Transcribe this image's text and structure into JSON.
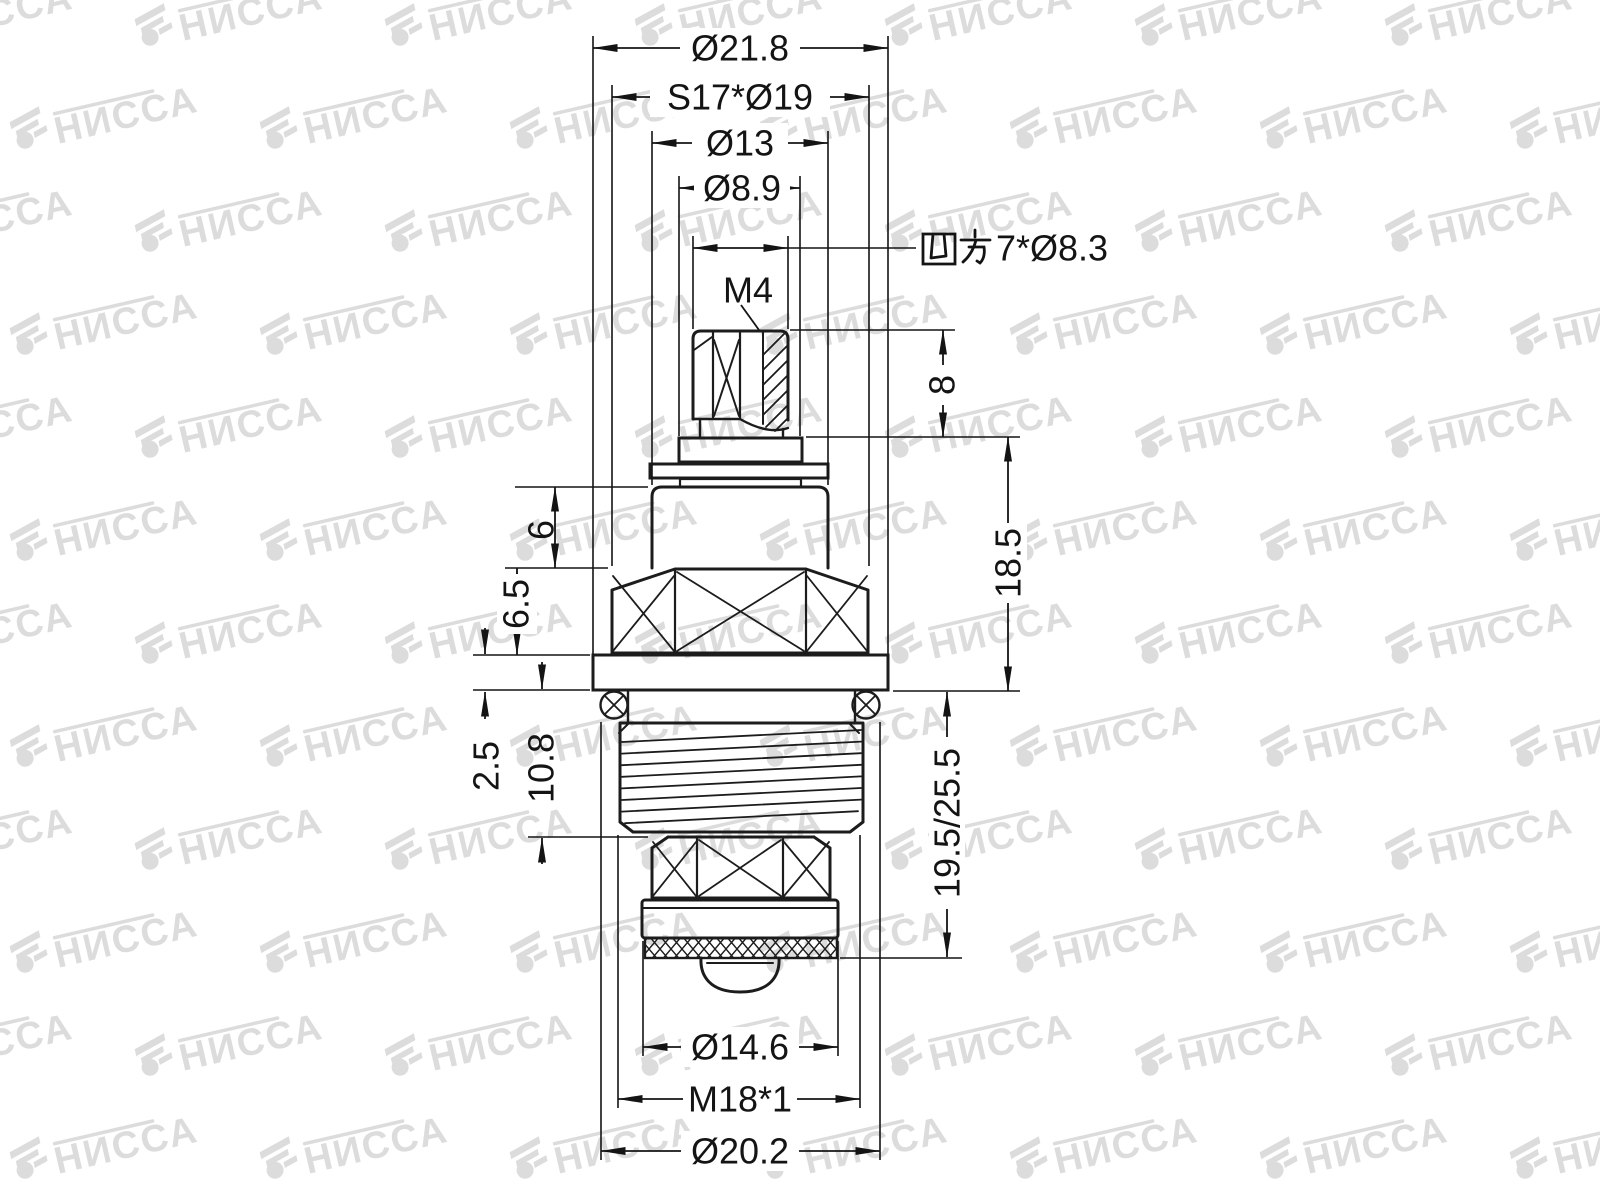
{
  "title": "Faucet cartridge technical drawing",
  "watermark": {
    "text": "НИССА",
    "color": "#dcdcdc"
  },
  "colors": {
    "line": "#1c1c1c",
    "dimension": "#141414",
    "background": "#ffffff"
  },
  "dims": {
    "dia_top_flange": "Ø21.8",
    "hex_flats_spec": "S17*Ø19",
    "dia_body": "Ø13",
    "dia_collar": "Ø8.9",
    "square_full": "四方7*Ø8.3",
    "square_prefix": "四方",
    "square_value": "7*Ø8.3",
    "m4_label": "M4",
    "h_stem": "8",
    "h_body": "6",
    "h_hex": "6.5",
    "t_flange": "2.5",
    "h_thread_zone": "10.8",
    "h_upper": "18.5",
    "h_lower": "19.5/25.5",
    "dia_seat": "Ø14.6",
    "thread_spec": "M18*1",
    "dia_orings": "Ø20.2"
  }
}
